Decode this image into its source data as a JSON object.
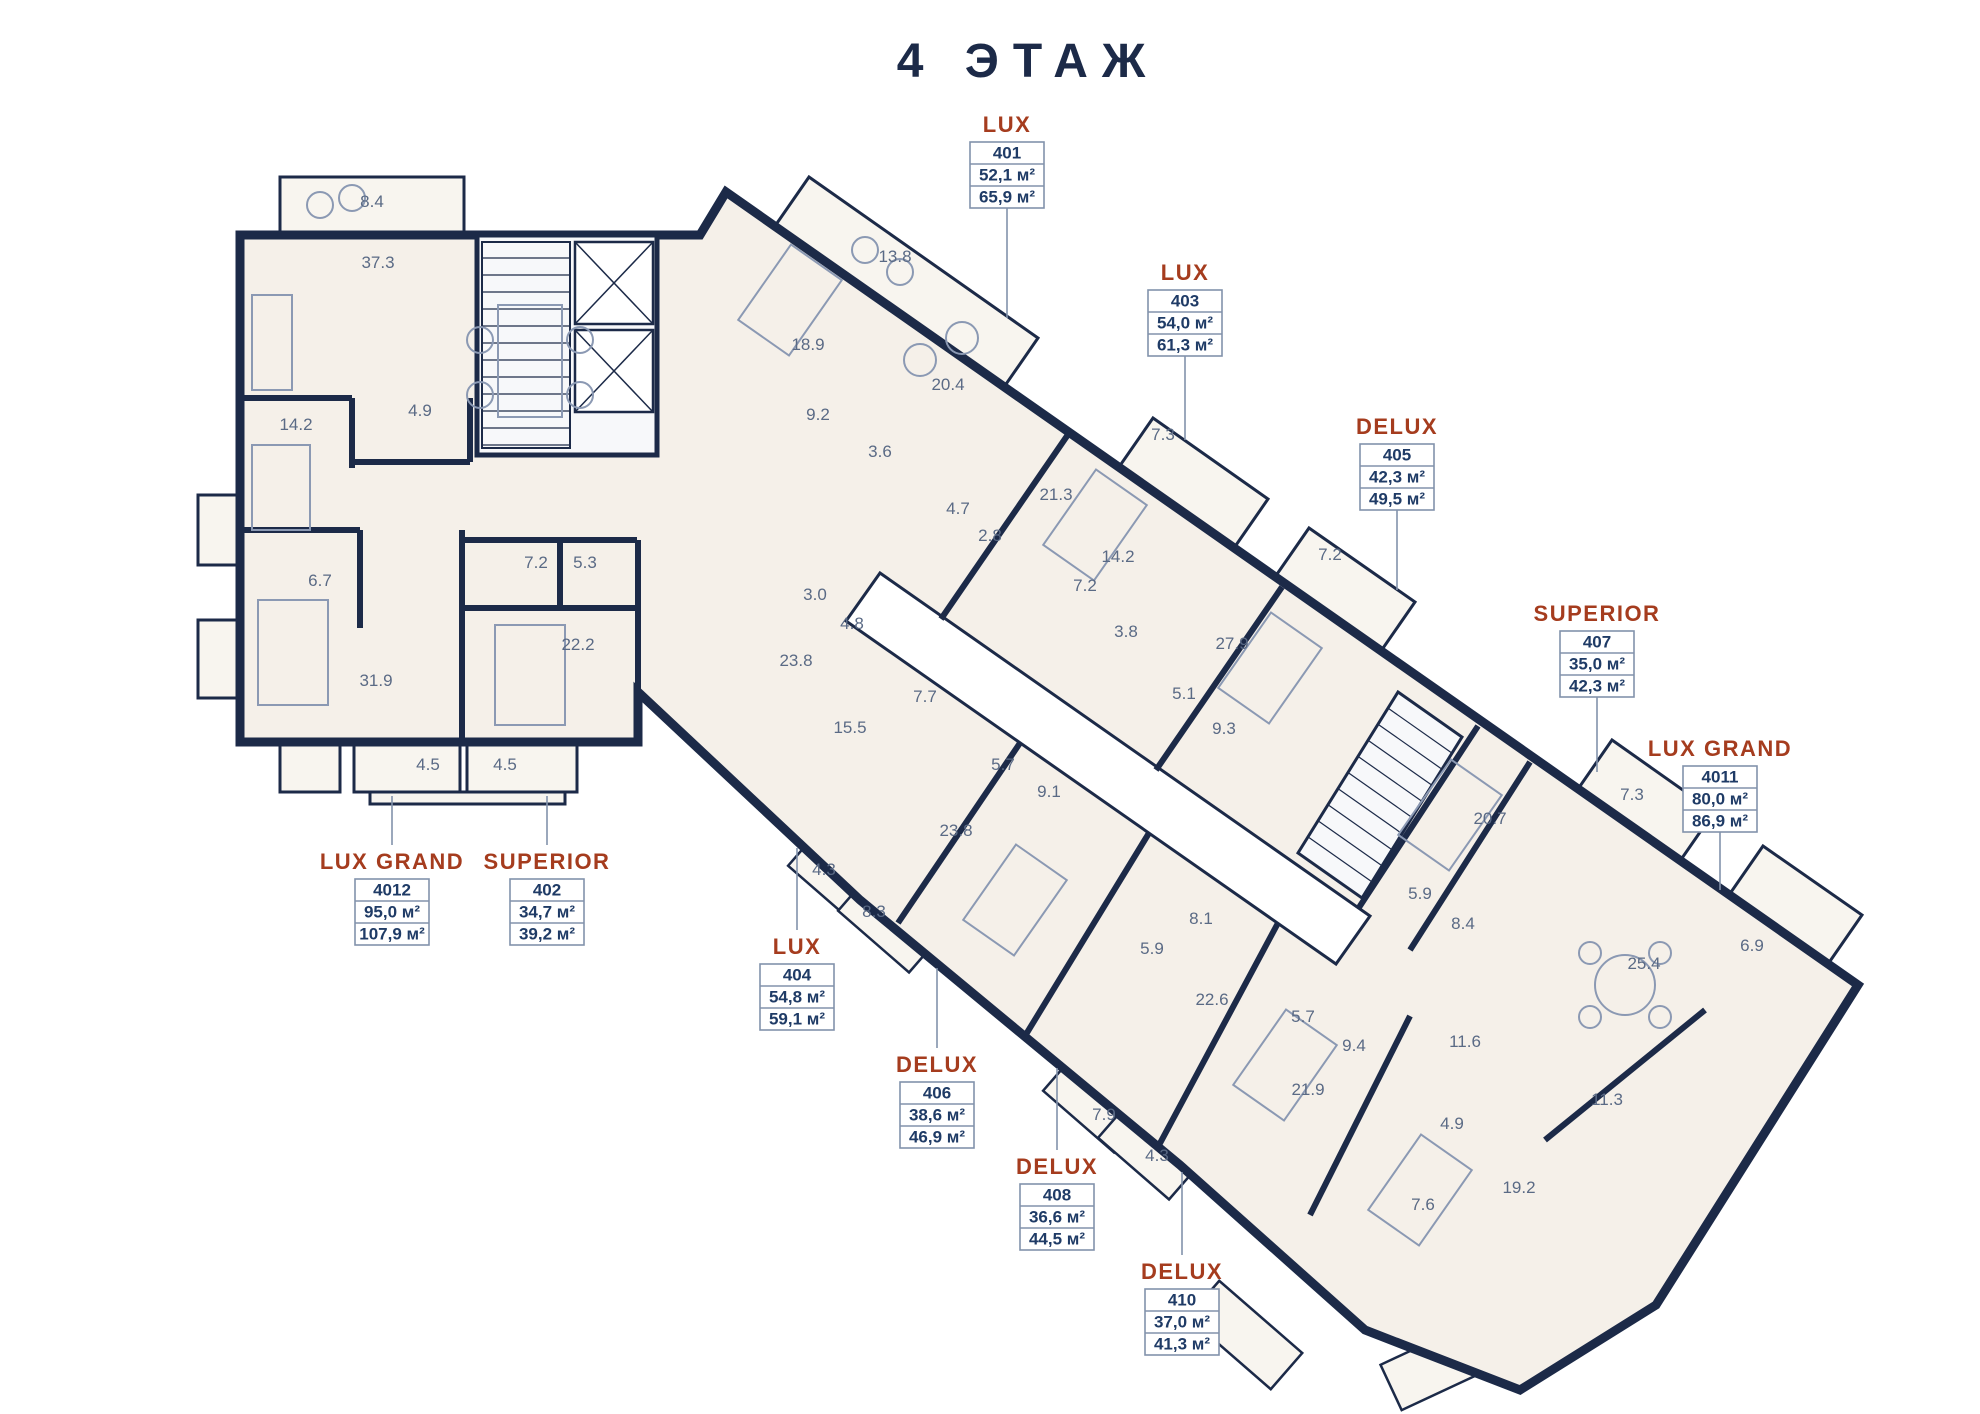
{
  "title": "4 ЭТАЖ",
  "area_unit": "м²",
  "colors": {
    "wall": "#1c2a48",
    "floor": "#f5f0e9",
    "balcony_floor": "#f8f5ef",
    "accent_unit_name": "#a53c1e",
    "room_label": "#5a6a85",
    "box_text": "#1f3b66",
    "box_border": "#8292ab",
    "furniture": "#8b99b3"
  },
  "units": [
    {
      "name": "LUX",
      "number": "401",
      "area1": "52,1 м²",
      "area2": "65,9 м²",
      "x": 1007,
      "box_y": 142,
      "leader": [
        1007,
        208,
        1007,
        318
      ]
    },
    {
      "name": "LUX",
      "number": "403",
      "area1": "54,0 м²",
      "area2": "61,3 м²",
      "x": 1185,
      "box_y": 290,
      "leader": [
        1185,
        356,
        1185,
        440
      ]
    },
    {
      "name": "DELUX",
      "number": "405",
      "area1": "42,3 м²",
      "area2": "49,5 м²",
      "x": 1397,
      "box_y": 444,
      "leader": [
        1397,
        510,
        1397,
        590
      ]
    },
    {
      "name": "SUPERIOR",
      "number": "407",
      "area1": "35,0 м²",
      "area2": "42,3 м²",
      "x": 1597,
      "box_y": 631,
      "leader": [
        1597,
        697,
        1597,
        772
      ]
    },
    {
      "name": "LUX GRAND",
      "number": "4011",
      "area1": "80,0 м²",
      "area2": "86,9 м²",
      "x": 1720,
      "box_y": 766,
      "leader": [
        1720,
        832,
        1720,
        890
      ]
    },
    {
      "name": "LUX GRAND",
      "number": "4012",
      "area1": "95,0 м²",
      "area2": "107,9 м²",
      "x": 392,
      "box_y": 879,
      "leader": [
        392,
        845,
        392,
        796
      ]
    },
    {
      "name": "SUPERIOR",
      "number": "402",
      "area1": "34,7 м²",
      "area2": "39,2 м²",
      "x": 547,
      "box_y": 879,
      "leader": [
        547,
        845,
        547,
        796
      ]
    },
    {
      "name": "LUX",
      "number": "404",
      "area1": "54,8 м²",
      "area2": "59,1 м²",
      "x": 797,
      "box_y": 964,
      "leader": [
        797,
        930,
        797,
        848
      ]
    },
    {
      "name": "DELUX",
      "number": "406",
      "area1": "38,6 м²",
      "area2": "46,9 м²",
      "x": 937,
      "box_y": 1082,
      "leader": [
        937,
        1048,
        937,
        968
      ]
    },
    {
      "name": "DELUX",
      "number": "408",
      "area1": "36,6 м²",
      "area2": "44,5 м²",
      "x": 1057,
      "box_y": 1184,
      "leader": [
        1057,
        1150,
        1057,
        1068
      ]
    },
    {
      "name": "DELUX",
      "number": "410",
      "area1": "37,0 м²",
      "area2": "41,3 м²",
      "x": 1182,
      "box_y": 1289,
      "leader": [
        1182,
        1255,
        1182,
        1172
      ]
    }
  ],
  "room_labels": [
    {
      "t": "8.4",
      "x": 372,
      "y": 207
    },
    {
      "t": "37.3",
      "x": 378,
      "y": 268
    },
    {
      "t": "14.2",
      "x": 296,
      "y": 430
    },
    {
      "t": "4.9",
      "x": 420,
      "y": 416
    },
    {
      "t": "6.7",
      "x": 320,
      "y": 586
    },
    {
      "t": "7.2",
      "x": 536,
      "y": 568
    },
    {
      "t": "5.3",
      "x": 585,
      "y": 568
    },
    {
      "t": "22.2",
      "x": 578,
      "y": 650
    },
    {
      "t": "31.9",
      "x": 376,
      "y": 686
    },
    {
      "t": "4.5",
      "x": 428,
      "y": 770
    },
    {
      "t": "4.5",
      "x": 505,
      "y": 770
    },
    {
      "t": "13.8",
      "x": 895,
      "y": 262
    },
    {
      "t": "18.9",
      "x": 808,
      "y": 350
    },
    {
      "t": "9.2",
      "x": 818,
      "y": 420
    },
    {
      "t": "20.4",
      "x": 948,
      "y": 390
    },
    {
      "t": "3.6",
      "x": 880,
      "y": 457
    },
    {
      "t": "4.7",
      "x": 958,
      "y": 514
    },
    {
      "t": "2.8",
      "x": 990,
      "y": 541
    },
    {
      "t": "21.3",
      "x": 1056,
      "y": 500
    },
    {
      "t": "7.3",
      "x": 1163,
      "y": 440
    },
    {
      "t": "14.2",
      "x": 1118,
      "y": 562
    },
    {
      "t": "7.2",
      "x": 1085,
      "y": 591
    },
    {
      "t": "3.8",
      "x": 1126,
      "y": 637
    },
    {
      "t": "7.2",
      "x": 1330,
      "y": 560
    },
    {
      "t": "27.9",
      "x": 1232,
      "y": 649
    },
    {
      "t": "5.1",
      "x": 1184,
      "y": 699
    },
    {
      "t": "9.3",
      "x": 1224,
      "y": 734
    },
    {
      "t": "20.7",
      "x": 1490,
      "y": 824
    },
    {
      "t": "7.3",
      "x": 1632,
      "y": 800
    },
    {
      "t": "5.9",
      "x": 1420,
      "y": 899
    },
    {
      "t": "8.4",
      "x": 1463,
      "y": 929
    },
    {
      "t": "25.4",
      "x": 1644,
      "y": 969
    },
    {
      "t": "6.9",
      "x": 1752,
      "y": 951
    },
    {
      "t": "11.6",
      "x": 1465,
      "y": 1047
    },
    {
      "t": "11.3",
      "x": 1607,
      "y": 1105
    },
    {
      "t": "19.2",
      "x": 1519,
      "y": 1193
    },
    {
      "t": "7.6",
      "x": 1423,
      "y": 1210
    },
    {
      "t": "4.9",
      "x": 1452,
      "y": 1129
    },
    {
      "t": "23.8",
      "x": 796,
      "y": 666
    },
    {
      "t": "3.0",
      "x": 815,
      "y": 600
    },
    {
      "t": "4.8",
      "x": 852,
      "y": 629
    },
    {
      "t": "7.7",
      "x": 925,
      "y": 702
    },
    {
      "t": "15.5",
      "x": 850,
      "y": 733
    },
    {
      "t": "5.7",
      "x": 1003,
      "y": 770
    },
    {
      "t": "9.1",
      "x": 1049,
      "y": 797
    },
    {
      "t": "23.8",
      "x": 956,
      "y": 836
    },
    {
      "t": "4.3",
      "x": 824,
      "y": 875
    },
    {
      "t": "8.3",
      "x": 874,
      "y": 917
    },
    {
      "t": "8.1",
      "x": 1201,
      "y": 924
    },
    {
      "t": "5.9",
      "x": 1152,
      "y": 954
    },
    {
      "t": "22.6",
      "x": 1212,
      "y": 1005
    },
    {
      "t": "5.7",
      "x": 1303,
      "y": 1022
    },
    {
      "t": "9.4",
      "x": 1354,
      "y": 1051
    },
    {
      "t": "21.9",
      "x": 1308,
      "y": 1095
    },
    {
      "t": "4.3",
      "x": 1157,
      "y": 1161
    },
    {
      "t": "7.9",
      "x": 1104,
      "y": 1120
    }
  ]
}
